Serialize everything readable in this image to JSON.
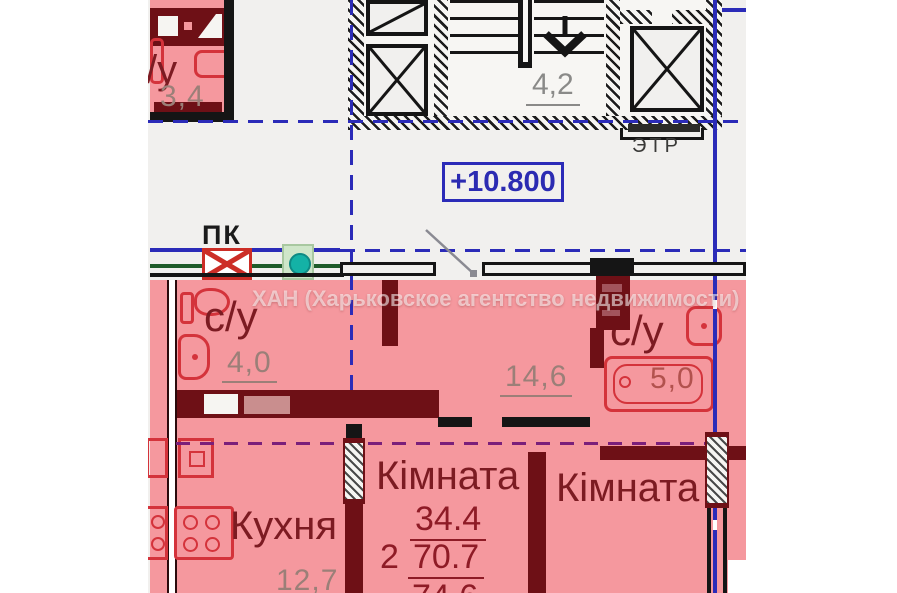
{
  "watermark": "ХАН (Харьковское агентство недвижимости)",
  "elevation": "+10.800",
  "pk_label": "ПК",
  "stairwell": {
    "landing_area": "4,2",
    "elevator_room": "ЭТР"
  },
  "neighbor": {
    "bath": "с/у",
    "bath_area": "3,4"
  },
  "unit": {
    "bath1": "с/у",
    "bath1_area": "4,0",
    "hall_area": "14,6",
    "bath2": "с/у",
    "bath2_area": "5,0",
    "kitchen": "Кухня",
    "kitchen_area": "12,7",
    "room1": "Кімната",
    "room2": "Кімната",
    "summary": {
      "rooms": "2",
      "living": "34.4",
      "area": "70.7",
      "total": "74.6"
    }
  },
  "colors": {
    "apartment_fill": "#f5989e",
    "wall_maroon": "#6e1016",
    "fixture_red": "#d4333b",
    "axis_blue": "#2b2bb8",
    "axis_purple": "#7a1f7a",
    "wall_black": "#151515",
    "label_gray": "#9b7f78",
    "label_dark": "#7c1b22",
    "plan_bg": "#f1f0ee",
    "green_line": "#1f5c2a"
  }
}
